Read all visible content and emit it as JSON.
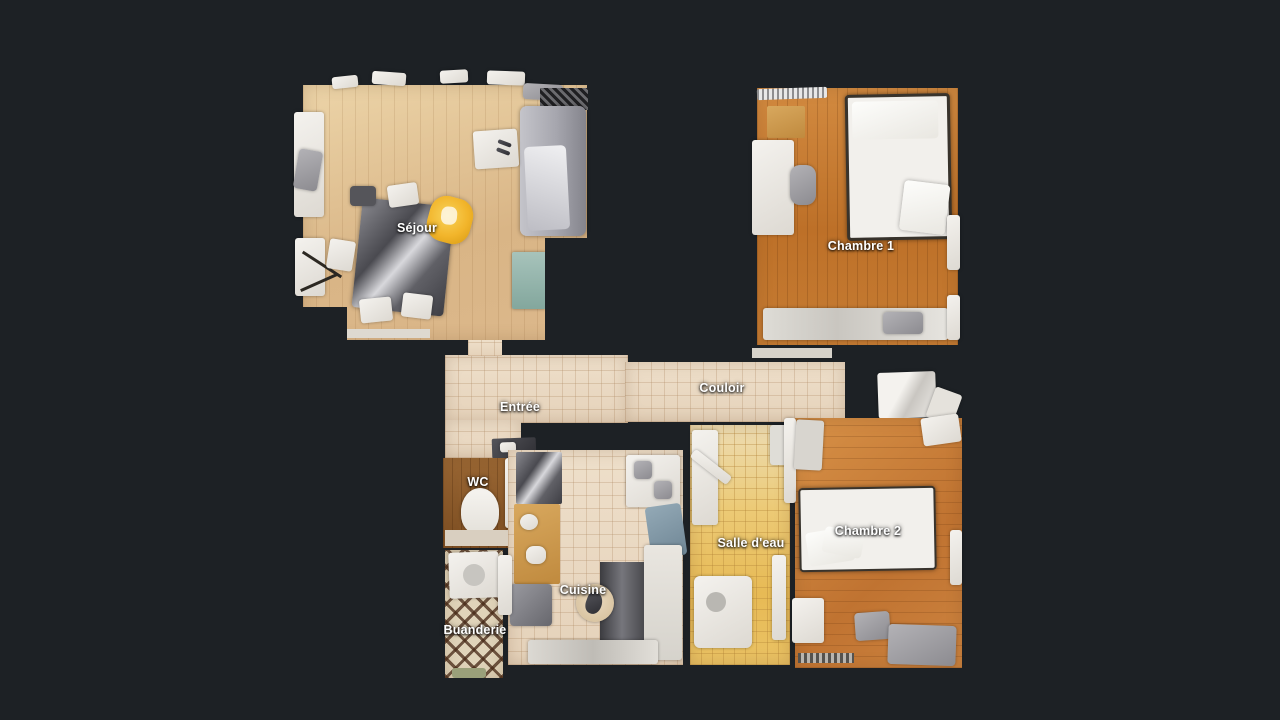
{
  "view": {
    "name": "apartment-floorplan-top-view",
    "background": "#1d2125"
  },
  "floorplan": {
    "rooms": [
      {
        "id": "sejour",
        "label": "Séjour",
        "floor": "light-wood"
      },
      {
        "id": "chambre1",
        "label": "Chambre 1",
        "floor": "orange-wood"
      },
      {
        "id": "entree",
        "label": "Entrée",
        "floor": "beige-tile"
      },
      {
        "id": "couloir",
        "label": "Couloir",
        "floor": "beige-tile"
      },
      {
        "id": "wc",
        "label": "WC",
        "floor": "brown-wood"
      },
      {
        "id": "cuisine",
        "label": "Cuisine",
        "floor": "beige-tile"
      },
      {
        "id": "salle-deau",
        "label": "Salle d'eau",
        "floor": "amber-tile"
      },
      {
        "id": "chambre2",
        "label": "Chambre 2",
        "floor": "orange-wood"
      },
      {
        "id": "buanderie",
        "label": "Buanderie",
        "floor": "diamond-tile"
      }
    ]
  },
  "colors": {
    "background": "#1d2125",
    "label_text": "#ffffff",
    "marker_yellow": "#f2b52b"
  }
}
